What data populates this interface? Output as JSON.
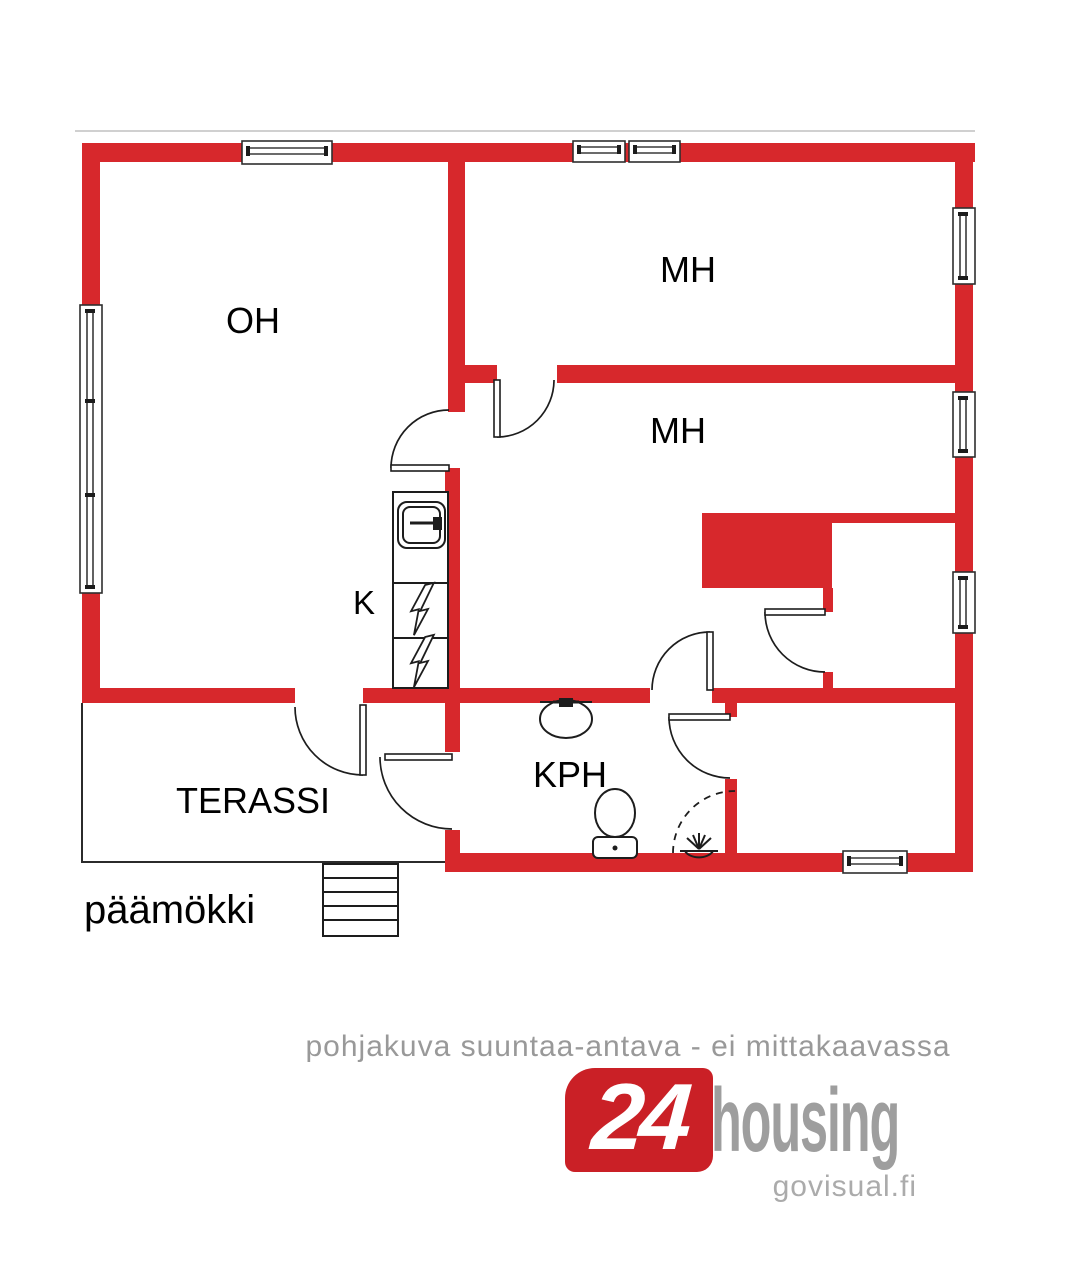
{
  "plan": {
    "building_label": "päämökki",
    "rooms": [
      {
        "name": "living-room",
        "label": "OH"
      },
      {
        "name": "bedroom-1",
        "label": "MH"
      },
      {
        "name": "bedroom-2",
        "label": "MH"
      },
      {
        "name": "kitchen",
        "label": "K"
      },
      {
        "name": "bathroom",
        "label": "KPH"
      },
      {
        "name": "terrace",
        "label": "TERASSI"
      }
    ]
  },
  "footer": {
    "disclaimer": "pohjakuva suuntaa-antava - ei mittakaavassa",
    "logo": {
      "number": "24",
      "name": "housing",
      "website": "govisual.fi"
    }
  },
  "colors": {
    "wall_red": "#d7282c",
    "logo_red": "#ca2026",
    "disclaimer_gray": "#999999",
    "logo_gray": "#9e9e9e",
    "site_gray": "#ababab"
  }
}
